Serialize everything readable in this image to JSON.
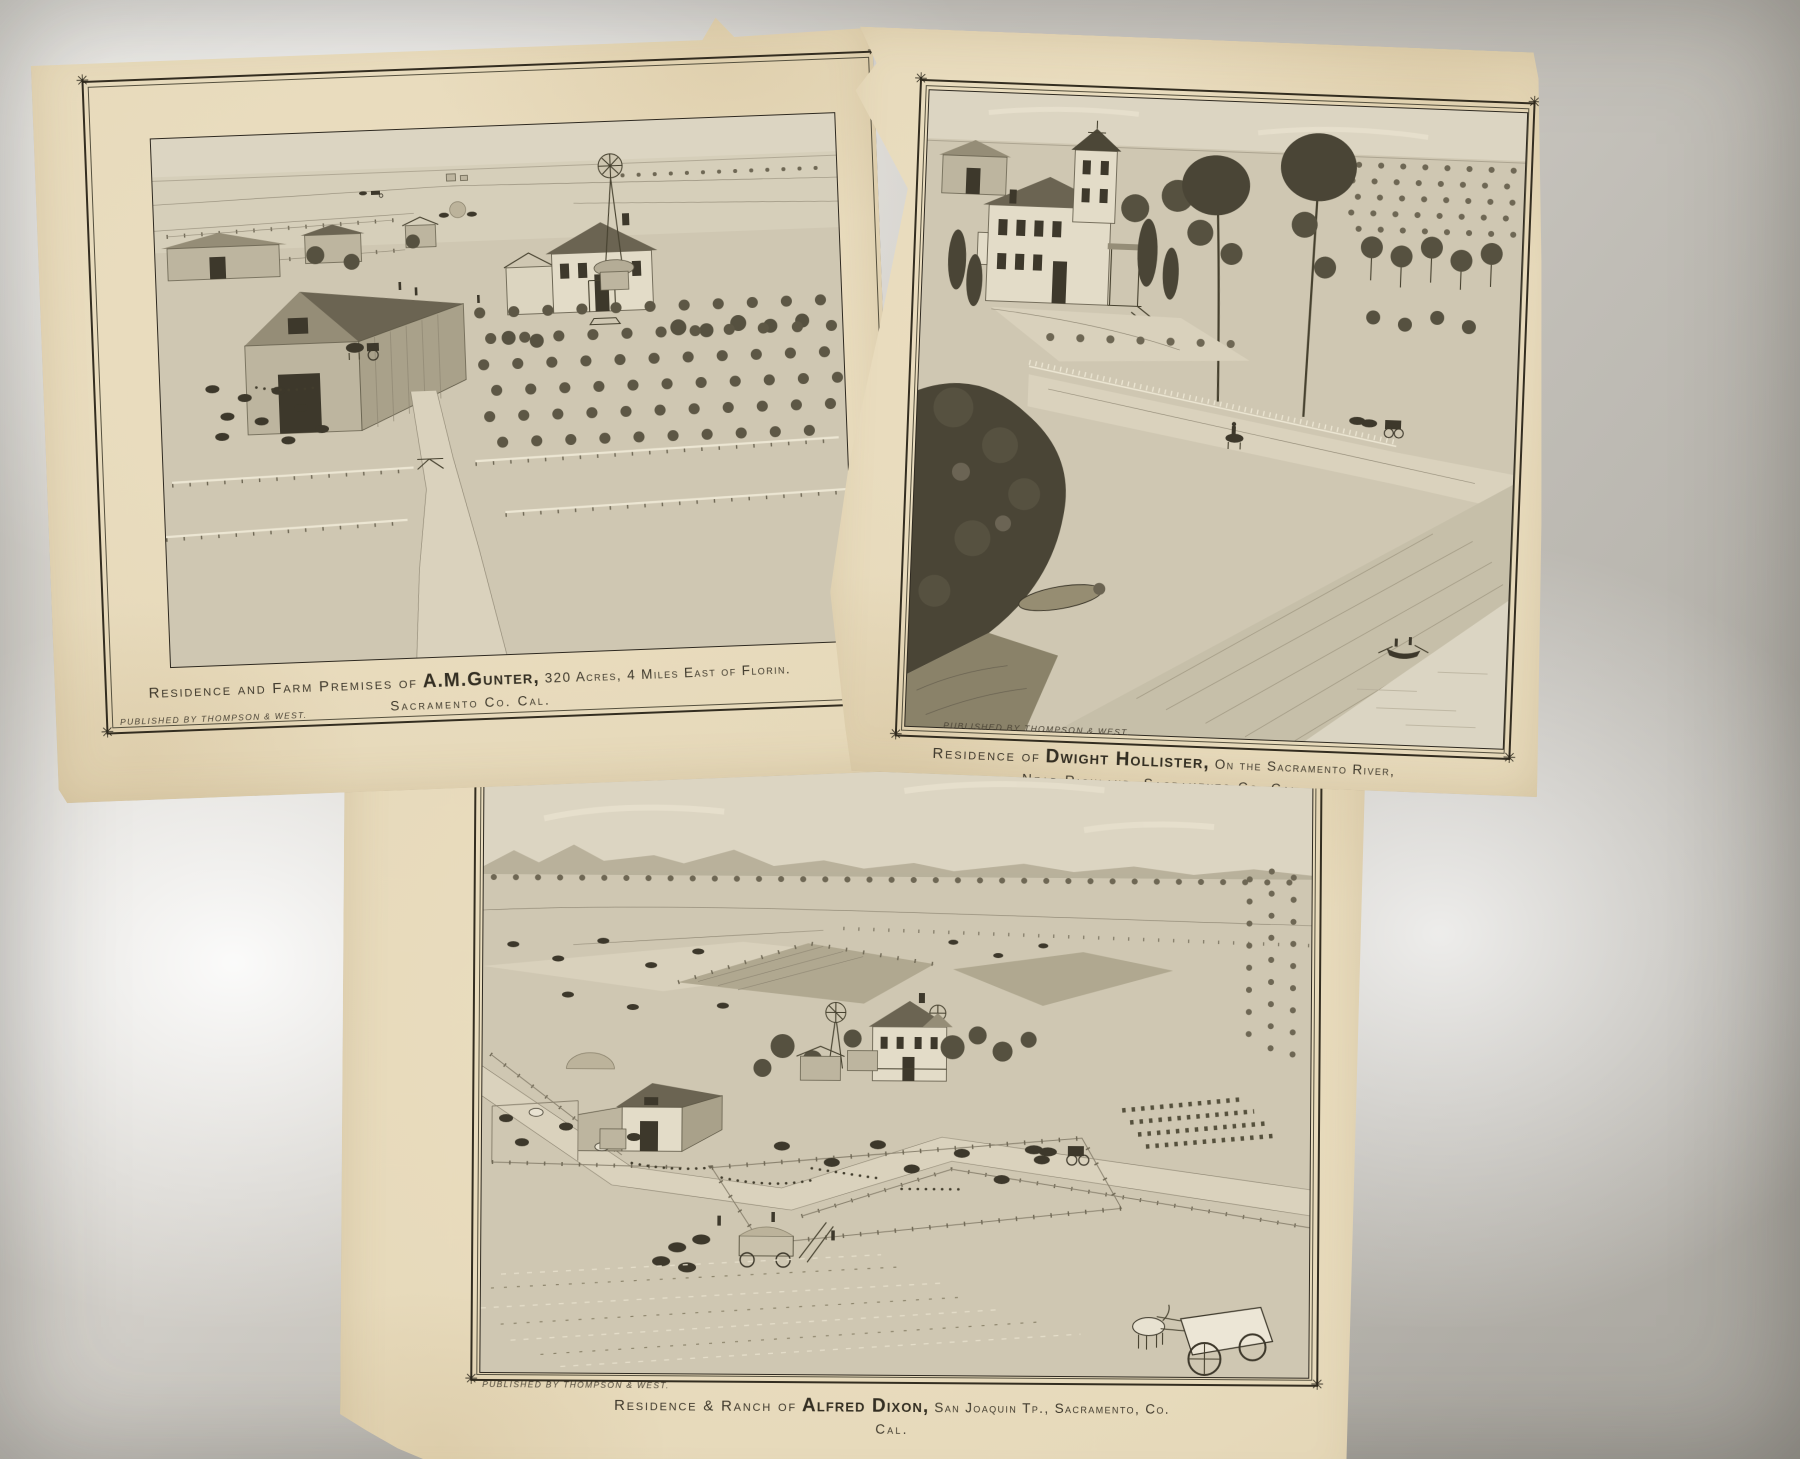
{
  "colors": {
    "paper": "#e6d9ba",
    "ink": "#3d382b",
    "table": "#c9c6bf",
    "frame": "#332d20"
  },
  "icons": {
    "corner_star": "✳"
  },
  "prints": [
    {
      "name": "gunter-farm",
      "publisher": "Published by Thompson & West.",
      "caption": {
        "prefix": "Residence and Farm Premises of",
        "subject": "A.M.Gunter,",
        "detail": "320 Acres,  4 Miles East of Florin.",
        "line2": "Sacramento Co. Cal."
      }
    },
    {
      "name": "hollister-residence",
      "publisher": "Published by Thompson & West.",
      "caption": {
        "prefix": "Residence of",
        "subject": "Dwight Hollister,",
        "detail": "On the Sacramento River,",
        "line2": "Near Richland, Sacramento Co. Cal."
      }
    },
    {
      "name": "dixon-ranch",
      "publisher": "Published by Thompson & West.",
      "caption": {
        "prefix": "Residence & Ranch of",
        "subject": "Alfred Dixon,",
        "detail": "San Joaquin Tp., Sacramento, Co.",
        "line2": "Cal."
      }
    }
  ]
}
